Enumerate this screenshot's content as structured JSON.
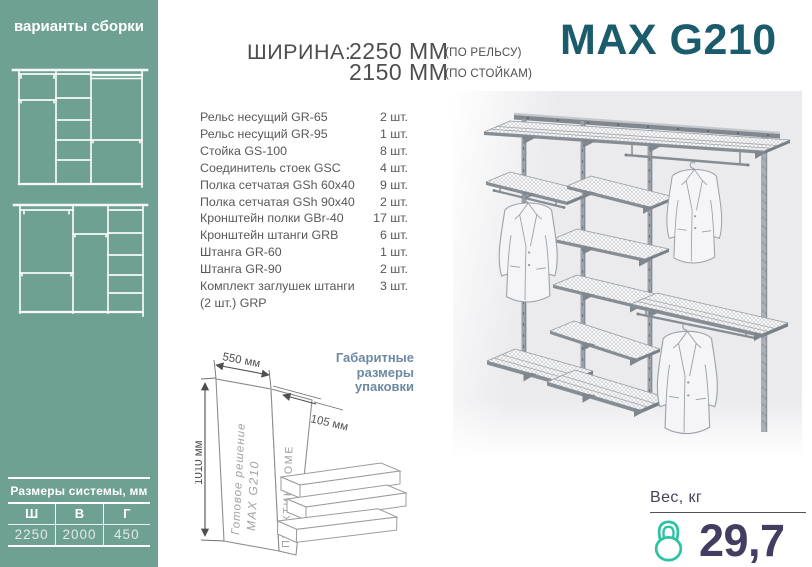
{
  "sidebar": {
    "bg_color": "#6fa192",
    "title": "варианты сборки",
    "size_table": {
      "title": "Размеры системы, мм",
      "columns": [
        "Ш",
        "В",
        "Г"
      ],
      "values": [
        "2250",
        "2000",
        "450"
      ]
    }
  },
  "header": {
    "width_label": "ШИРИНА:",
    "rail_width": "2250 ММ",
    "rail_note": "(ПО РЕЛЬСУ)",
    "post_width": "2150 ММ",
    "post_note": "(ПО СТОЙКАМ)",
    "logo": "MAX G210",
    "logo_color": "#1b5c6c"
  },
  "parts": {
    "items": [
      {
        "name": "Рельс несущий GR-65",
        "qty": "2 шт."
      },
      {
        "name": "Рельс несущий GR-95",
        "qty": "1 шт."
      },
      {
        "name": "Стойка GS-100",
        "qty": "8 шт."
      },
      {
        "name": "Соединитель стоек GSC",
        "qty": "4 шт."
      },
      {
        "name": "Полка сетчатая GSh 60x40",
        "qty": "9 шт."
      },
      {
        "name": "Полка сетчатая GSh 90x40",
        "qty": "2 шт."
      },
      {
        "name": "Кронштейн полки GBr-40",
        "qty": "17 шт."
      },
      {
        "name": "Кронштейн штанги GRB",
        "qty": "6 шт."
      },
      {
        "name": "Штанга GR-60",
        "qty": "1 шт."
      },
      {
        "name": "Штанга GR-90",
        "qty": "2 шт."
      },
      {
        "name": "Комплект заглушек штанги (2 шт.) GRP",
        "qty": "3 шт."
      }
    ]
  },
  "package": {
    "label": "Габаритные размеры упаковки",
    "dim_width": "550 мм",
    "dim_depth": "105 мм",
    "dim_height": "1010 мм",
    "box_line1": "Готовое решение",
    "box_line2": "MAX G210",
    "box_side": "ПРАКТИК HOME"
  },
  "weight": {
    "label": "Вес, кг",
    "value": "29,7",
    "icon": "kettlebell-icon",
    "icon_color": "#2cc3a2"
  }
}
